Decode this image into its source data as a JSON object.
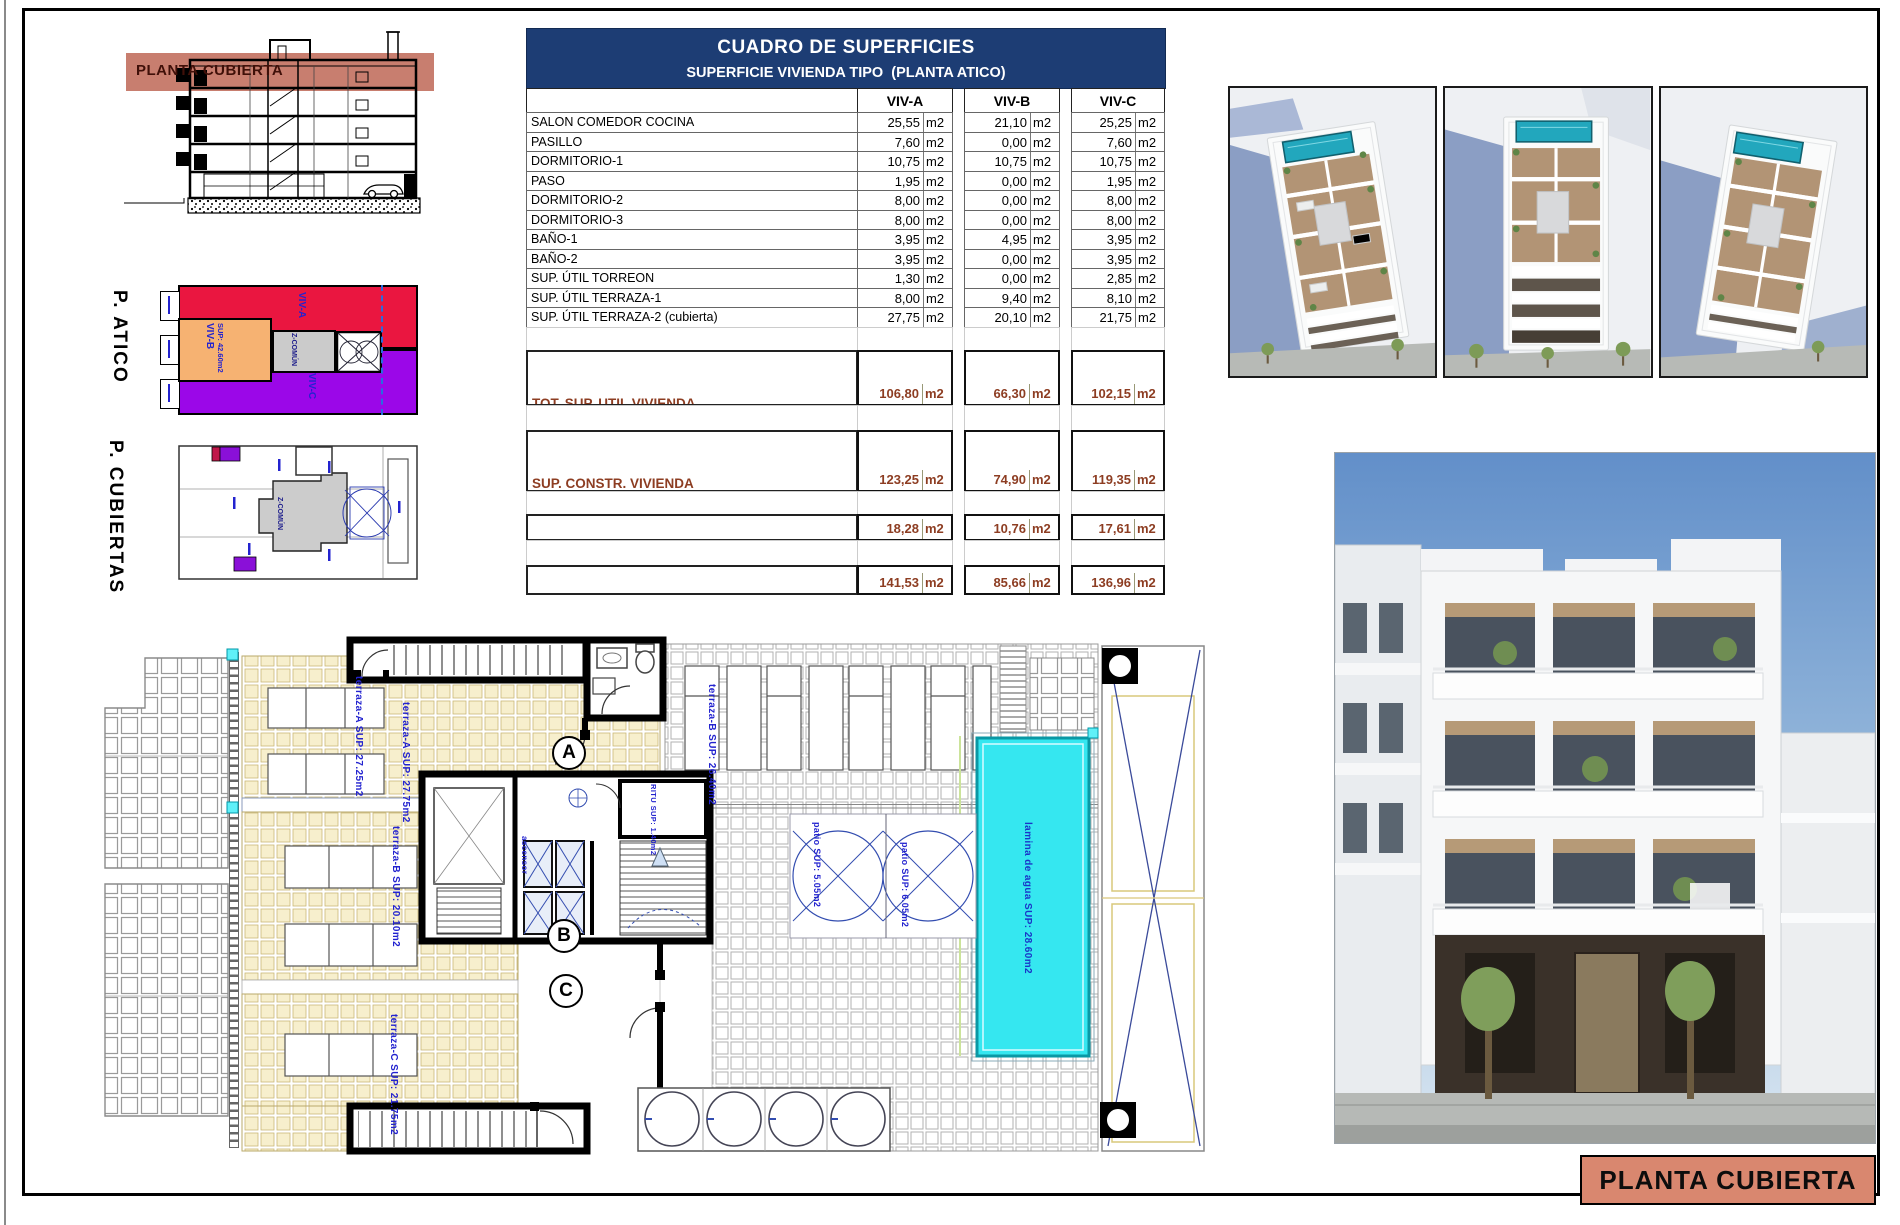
{
  "colors": {
    "header_navy": "#1d3d74",
    "band_salmon": "#c87e6f",
    "title_block_salmon": "#d9876f",
    "summary_brown": "#8d3d22",
    "annotation_blue": "#2323cf",
    "pool_cyan": "#35e7f0",
    "viv_a_red": "#ea1640",
    "viv_b_orange": "#f6b272",
    "viv_c_purple": "#9b07e8",
    "z_comun_gray": "#cbcbcb",
    "terrace_cream": "#f7efcd"
  },
  "section": {
    "band_label": "PLANTA CUBIERTA"
  },
  "side_plans": {
    "atico_label": "P. ATICO",
    "cubiertas_label": "P. CUBIERTAS",
    "atico_zones": {
      "viv_a": "VIV-A",
      "viv_b": "VIV-B",
      "viv_b_sup": "SUP: 42.60m2",
      "z_comun": "Z-COMÚN",
      "viv_c": "VIV-C"
    },
    "cubiertas_zones": {
      "z_comun": "Z-COMÚN"
    }
  },
  "table": {
    "title": "CUADRO DE SUPERFICIES",
    "subtitle": "SUPERFICIE VIVIENDA TIPO  (PLANTA ATICO)",
    "unit": "m2",
    "columns": [
      "VIV-A",
      "VIV-B",
      "VIV-C"
    ],
    "rows": [
      {
        "label": "SALON COMEDOR COCINA",
        "values": [
          "25,55",
          "21,10",
          "25,25"
        ]
      },
      {
        "label": "PASILLO",
        "values": [
          "7,60",
          "0,00",
          "7,60"
        ]
      },
      {
        "label": "DORMITORIO-1",
        "values": [
          "10,75",
          "10,75",
          "10,75"
        ]
      },
      {
        "label": "PASO",
        "values": [
          "1,95",
          "0,00",
          "1,95"
        ]
      },
      {
        "label": "DORMITORIO-2",
        "values": [
          "8,00",
          "0,00",
          "8,00"
        ]
      },
      {
        "label": "DORMITORIO-3",
        "values": [
          "8,00",
          "0,00",
          "8,00"
        ]
      },
      {
        "label": "BAÑO-1",
        "values": [
          "3,95",
          "4,95",
          "3,95"
        ]
      },
      {
        "label": "BAÑO-2",
        "values": [
          "3,95",
          "0,00",
          "3,95"
        ]
      },
      {
        "label": "SUP. ÚTIL TORREON",
        "values": [
          "1,30",
          "0,00",
          "2,85"
        ]
      },
      {
        "label": "SUP. ÚTIL TERRAZA-1",
        "values": [
          "8,00",
          "9,40",
          "8,10"
        ]
      },
      {
        "label": "SUP. ÚTIL TERRAZA-2 (cubierta)",
        "values": [
          "27,75",
          "20,10",
          "21,75"
        ]
      }
    ],
    "summary_rows": [
      {
        "label_line1": "TOT. SUP. UTIL VIVIENDA",
        "label_line2": "(Terrazas cubiertas y galerías al 100%)",
        "values": [
          "106,80",
          "66,30",
          "102,15"
        ]
      },
      {
        "label_line1": "SUP. CONSTR. VIVIENDA",
        "label_line2": "(sin E.Comunes, terrazas 100%)",
        "values": [
          "123,25",
          "74,90",
          "119,35"
        ]
      },
      {
        "label_line1": "SUP. CONSTRUIDA COMUNES",
        "label_line2": "",
        "values": [
          "18,28",
          "10,76",
          "17,61"
        ]
      },
      {
        "label_line1": "SUPERFIIE CONSTRUIDA TOTAL",
        "label_line2": "",
        "values": [
          "141,53",
          "85,66",
          "136,96"
        ]
      }
    ]
  },
  "floor_plan": {
    "markers": [
      "A",
      "B",
      "C"
    ],
    "labels": {
      "terraza_a1": "terraza-A SUP: 27.25m2",
      "terraza_a2": "terraza-A SUP: 27.75m2",
      "terraza_b1": "terraza-B SUP: 26.40m2",
      "terraza_b2": "terraza-B SUP: 20.10m2",
      "terraza_c": "terraza-C SUP: 21.75m2",
      "patio_1": "patio SUP: 5.05m2",
      "patio_2": "patio SUP: 6.05m2",
      "pool": "lamina de agua SUP: 28.60m2",
      "ritu": "RITU SUP: 1.40m2",
      "ascensor": "ascensor"
    }
  },
  "title_block": {
    "label": "PLANTA CUBIERTA"
  }
}
